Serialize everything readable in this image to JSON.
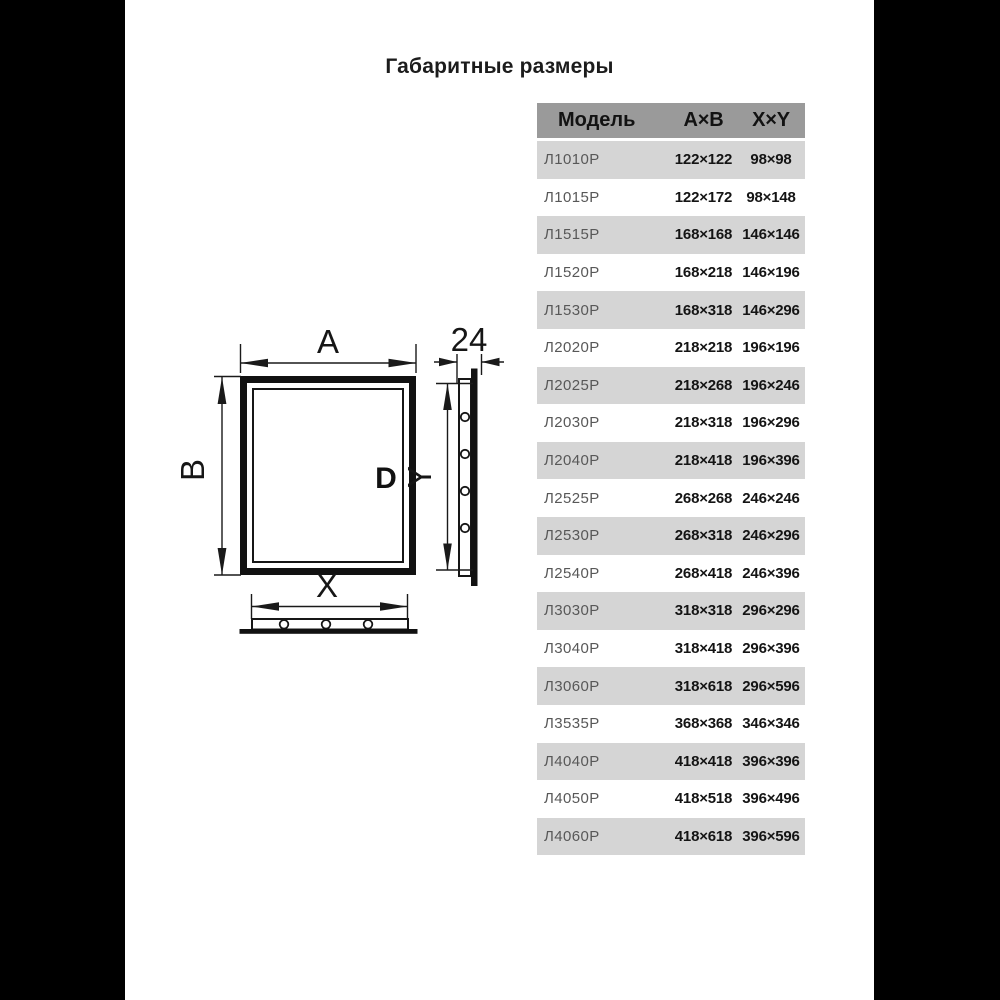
{
  "page": {
    "title": "Габаритные размеры",
    "background": "#000000",
    "card_background": "#ffffff"
  },
  "table": {
    "header": {
      "model": "Модель",
      "ab": "А×В",
      "xy": "X×Y"
    },
    "colors": {
      "header_bg": "#9a9a9a",
      "row_alt_bg": "#d5d5d5",
      "row_bg": "#ffffff",
      "model_text": "#585858",
      "value_text": "#141414"
    },
    "rows": [
      {
        "model": "Л1010Р",
        "ab": "122×122",
        "xy": "98×98"
      },
      {
        "model": "Л1015Р",
        "ab": "122×172",
        "xy": "98×148"
      },
      {
        "model": "Л1515Р",
        "ab": "168×168",
        "xy": "146×146"
      },
      {
        "model": "Л1520Р",
        "ab": "168×218",
        "xy": "146×196"
      },
      {
        "model": "Л1530Р",
        "ab": "168×318",
        "xy": "146×296"
      },
      {
        "model": "Л2020Р",
        "ab": "218×218",
        "xy": "196×196"
      },
      {
        "model": "Л2025Р",
        "ab": "218×268",
        "xy": "196×246"
      },
      {
        "model": "Л2030Р",
        "ab": "218×318",
        "xy": "196×296"
      },
      {
        "model": "Л2040Р",
        "ab": "218×418",
        "xy": "196×396"
      },
      {
        "model": "Л2525Р",
        "ab": "268×268",
        "xy": "246×246"
      },
      {
        "model": "Л2530Р",
        "ab": "268×318",
        "xy": "246×296"
      },
      {
        "model": "Л2540Р",
        "ab": "268×418",
        "xy": "246×396"
      },
      {
        "model": "Л3030Р",
        "ab": "318×318",
        "xy": "296×296"
      },
      {
        "model": "Л3040Р",
        "ab": "318×418",
        "xy": "296×396"
      },
      {
        "model": "Л3060Р",
        "ab": "318×618",
        "xy": "296×596"
      },
      {
        "model": "Л3535Р",
        "ab": "368×368",
        "xy": "346×346"
      },
      {
        "model": "Л4040Р",
        "ab": "418×418",
        "xy": "396×396"
      },
      {
        "model": "Л4050Р",
        "ab": "418×518",
        "xy": "396×496"
      },
      {
        "model": "Л4060Р",
        "ab": "418×618",
        "xy": "396×596"
      }
    ]
  },
  "drawing": {
    "labels": {
      "width": "A",
      "height": "B",
      "cutout_width": "X",
      "cutout_height": "Y",
      "depth": "24",
      "handle": "D"
    }
  }
}
